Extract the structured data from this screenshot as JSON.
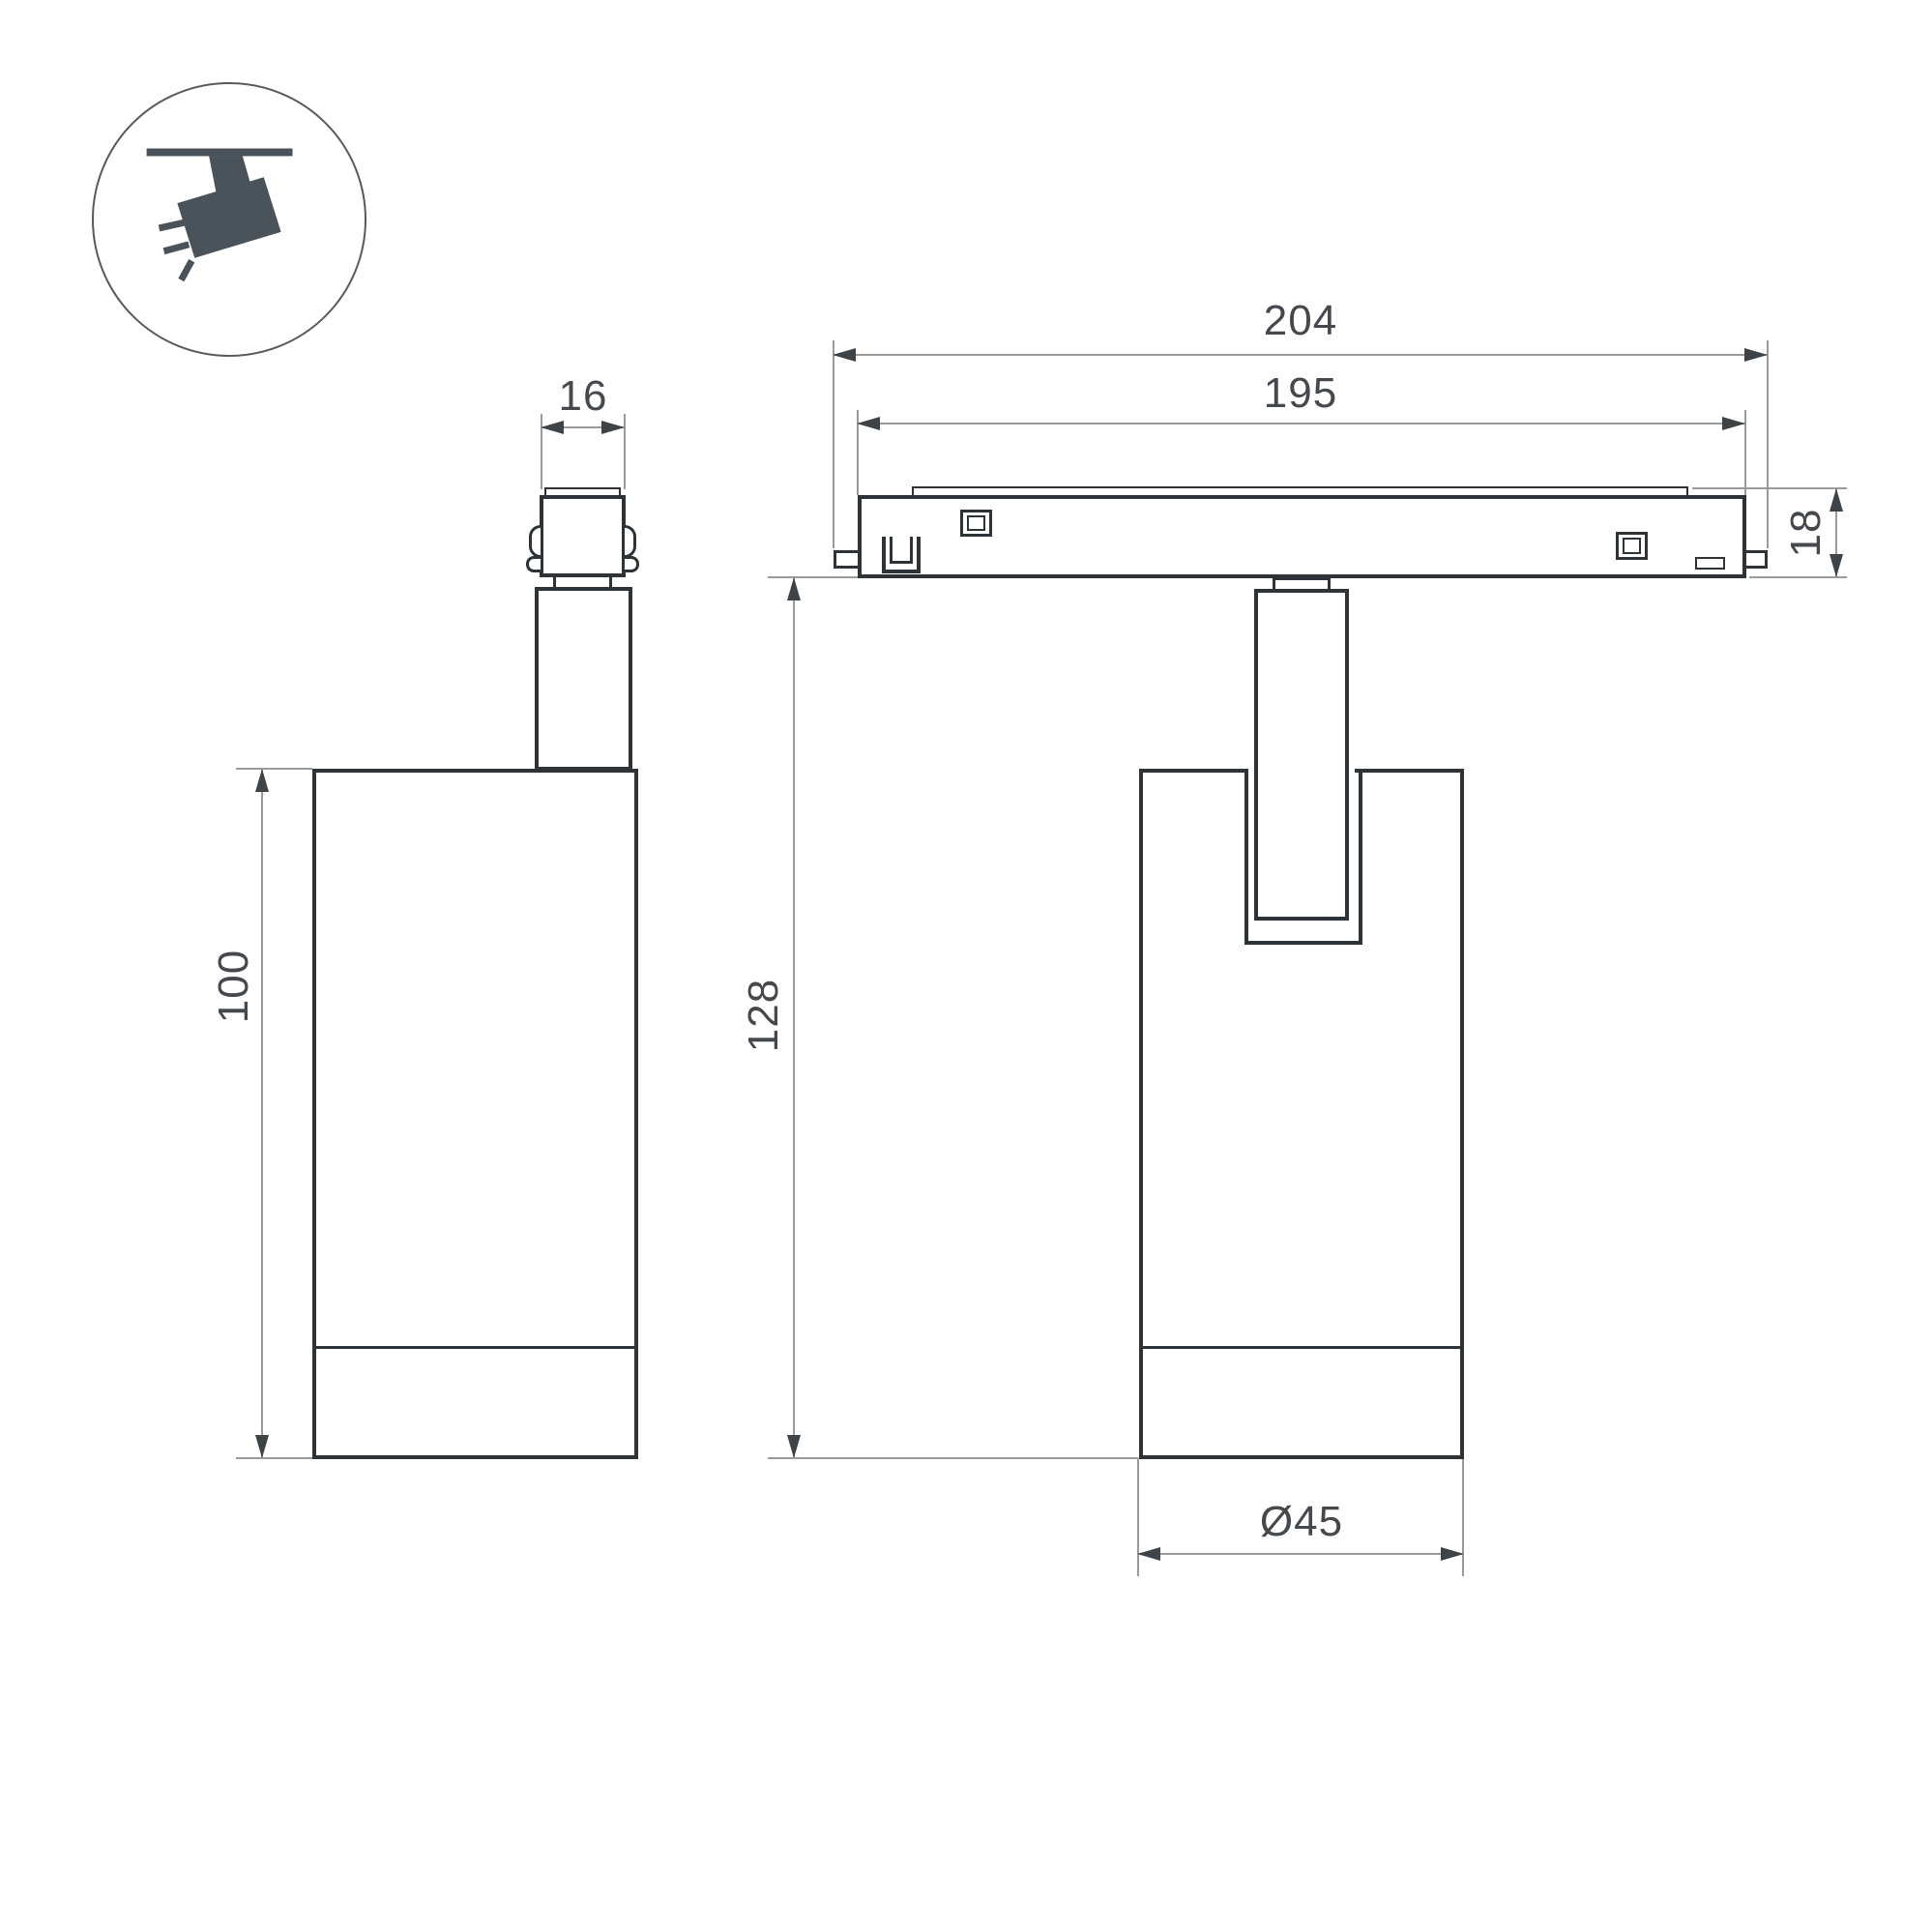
{
  "page": {
    "background": "#ffffff",
    "type": "technical dimensional drawing of magnetic track spotlight"
  },
  "icon": {
    "name": "ceiling-track-spotlight-icon",
    "fill": "#4a525a",
    "ring": "#565b60"
  },
  "colors": {
    "outline": "#2e3338",
    "dim_line": "#9b9b9b",
    "dim_text": "#45494e",
    "arrow": "#3e4348"
  },
  "views": {
    "side_view": {
      "name": "side view",
      "dimensions": {
        "adapter_width_mm": "16",
        "body_height_mm": "100"
      }
    },
    "front_view": {
      "name": "front view on track",
      "dimensions": {
        "track_outer_mm": "204",
        "track_inner_mm": "195",
        "track_height_mm": "18",
        "overall_height_mm": "128",
        "body_diameter_mm": "Ø45"
      }
    }
  }
}
